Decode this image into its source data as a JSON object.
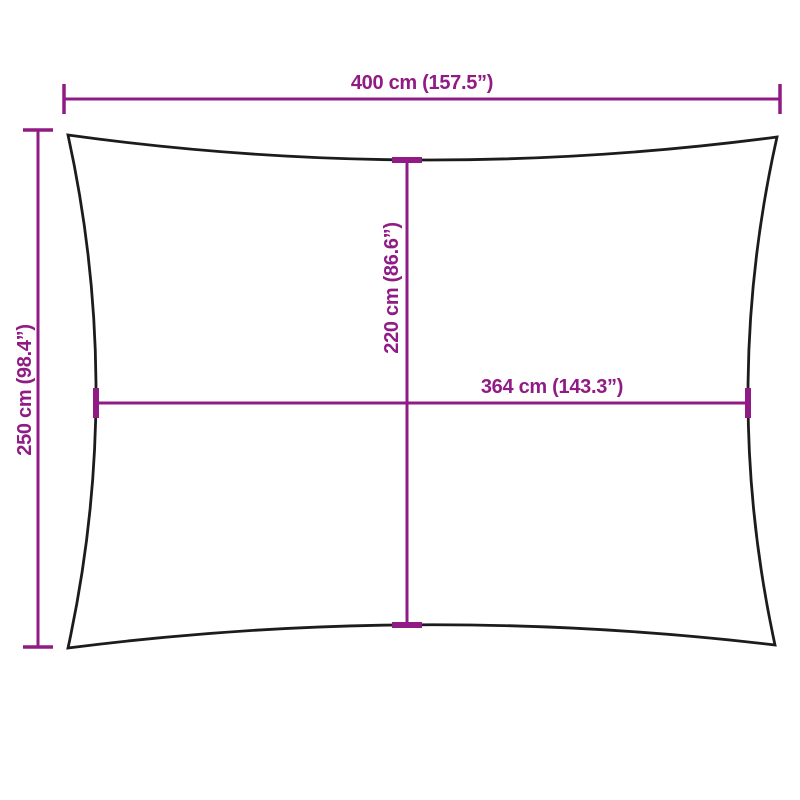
{
  "diagram": {
    "kind": "product-dimension-diagram",
    "subject": "rectangular shade sail outline with concave edges",
    "colors": {
      "dimension": "#911b84",
      "outline": "#1c1c1c",
      "background": "#ffffff"
    },
    "dimensions": {
      "top_width": {
        "label": "400 cm (157.5”)",
        "value_cm": 400,
        "value_inches": 157.5,
        "placement": "above diagram, horizontal overall width"
      },
      "left_height": {
        "label": "250 cm (98.4”)",
        "value_cm": 250,
        "value_inches": 98.4,
        "placement": "left of diagram, vertical overall height, rotated text"
      },
      "inner_height": {
        "label": "220 cm (86.6”)",
        "value_cm": 220,
        "value_inches": 86.6,
        "placement": "inside diagram, vertical center line, rotated text"
      },
      "inner_width": {
        "label": "364 cm (143.3”)",
        "value_cm": 364,
        "value_inches": 143.3,
        "placement": "inside diagram, horizontal center line"
      }
    }
  }
}
